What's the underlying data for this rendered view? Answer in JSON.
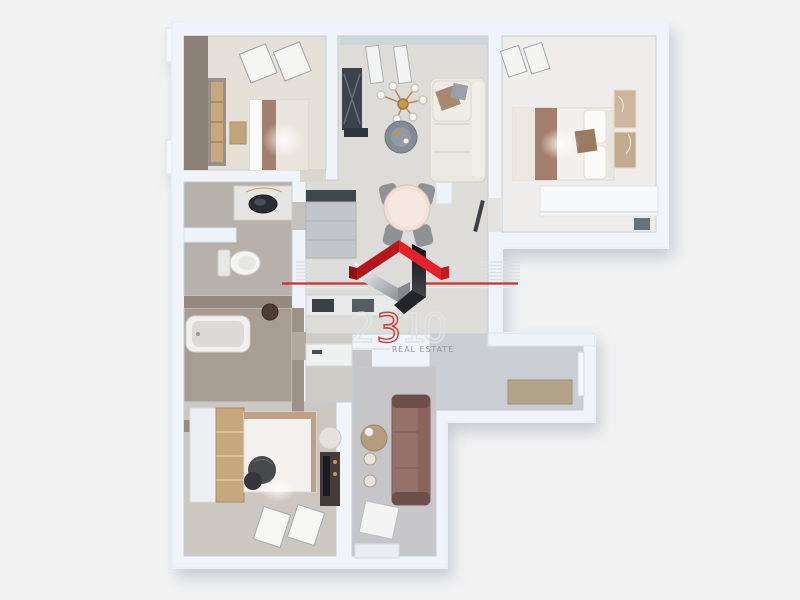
{
  "scene": {
    "description": "3D top-down rendered apartment floor plan",
    "background_color": "#f2f2f3"
  },
  "logo": {
    "digits": [
      "2",
      "3",
      "1",
      "0"
    ],
    "digit_colors": [
      "#e2e3e6",
      "#cf3a36",
      "#e2e3e6",
      "#e2e3e6"
    ],
    "tagline": "REAL ESTATE",
    "tagline_color": "#95959c",
    "roof_red_bright": "#e62129",
    "roof_red_dark": "#b5151c",
    "ribbon_dark": "#1a1b20",
    "ribbon_chrome": "#d9dadd",
    "accent_line_red": "#c63336",
    "accent_line_silver": "#dcdee0"
  },
  "palette": {
    "wall": "#f0f4f8",
    "wall_edge": "#d8e2ea",
    "floor_bedroom_tl": "#e6e1d8",
    "floor_living": "#dddcd9",
    "floor_bedroom_tr": "#eeedeb",
    "floor_bath_top": "#b6b1ab",
    "floor_bath_taupe": "#a79d91",
    "floor_corridor": "#cbced2",
    "floor_bedroom_bottom": "#ccc7c0",
    "floor_lounge": "#c6c6c8",
    "bed_brown": "#a3806d",
    "sofa_cream": "#ebe8e1",
    "sofa_mauve": "#96716b",
    "tv_unit_dark": "#3c424b",
    "wood_accent": "#c7a77c",
    "doormat": "#b2a38b",
    "chair_gray": "#8f9295",
    "table_top": "#f0e1d8"
  },
  "rooms": [
    {
      "id": "bedroom-top-left",
      "items": [
        "wardrobe",
        "double-bed",
        "windows",
        "nightstand"
      ]
    },
    {
      "id": "living-dining",
      "items": [
        "tv-unit",
        "chandelier",
        "coffee-table",
        "corner-sofa",
        "dining-table",
        "chairs"
      ]
    },
    {
      "id": "bedroom-top-right",
      "items": [
        "double-bed",
        "wardrobe-panels",
        "desk-unit",
        "window"
      ]
    },
    {
      "id": "bathroom",
      "items": [
        "vanity-sink",
        "toilet"
      ]
    },
    {
      "id": "bathroom-taupe",
      "items": [
        "bathtub",
        "wall-basin"
      ]
    },
    {
      "id": "kitchen",
      "items": [
        "cabinet-run",
        "hob",
        "sink-counter"
      ]
    },
    {
      "id": "entry-corridor",
      "items": [
        "doormat",
        "entry-door"
      ]
    },
    {
      "id": "bedroom-bottom",
      "items": [
        "wardrobe",
        "bed",
        "dark-blanket",
        "desk",
        "pouf",
        "windows"
      ]
    },
    {
      "id": "lounge-bottom",
      "items": [
        "mauve-sofa",
        "side-table",
        "floor-candles",
        "window"
      ]
    }
  ]
}
